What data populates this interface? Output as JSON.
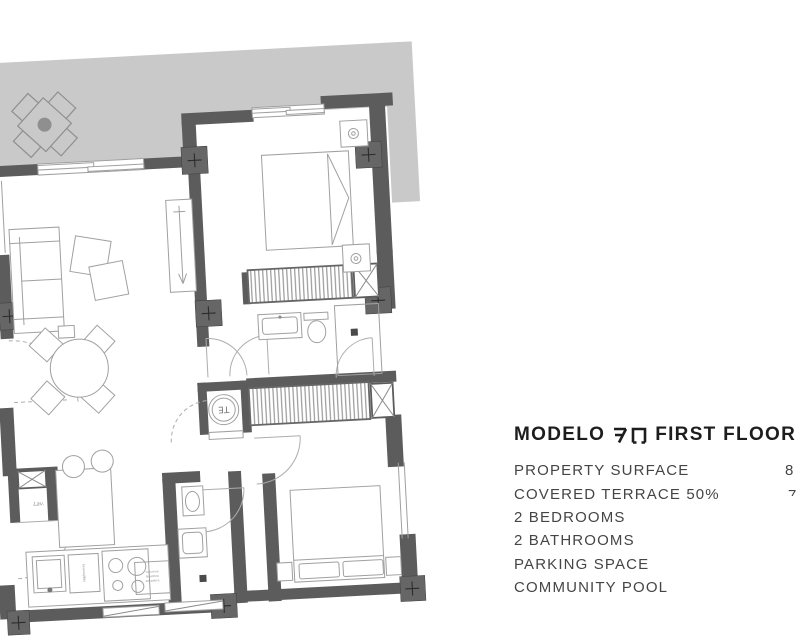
{
  "panel": {
    "title_prefix": "MODELO",
    "model_code": "7D",
    "title_suffix": "FIRST FLOOR",
    "features": [
      {
        "label": "PROPERTY SURFACE",
        "value": "8"
      },
      {
        "label": "COVERED TERRACE 50%",
        "value": "7"
      },
      {
        "label": "2 BEDROOMS",
        "value": ""
      },
      {
        "label": "2 BATHROOMS",
        "value": ""
      },
      {
        "label": "PARKING SPACE",
        "value": ""
      },
      {
        "label": "COMMUNITY POOL",
        "value": ""
      }
    ]
  },
  "floorplan": {
    "labels": {
      "water_heater": "TE",
      "laundry_closet": "Lav.",
      "dishwasher": "lavavajillas",
      "laundry_column_line1": "columna",
      "laundry_column_line2": "lavadora",
      "laundry_column_line3": "secadora"
    },
    "colors": {
      "wall": "#5c5c5c",
      "terrace": "#c9c9c9",
      "line": "#a0a0a0",
      "hatch": "#909090",
      "ink": "#1d1d1d",
      "ink2": "#454545"
    }
  }
}
